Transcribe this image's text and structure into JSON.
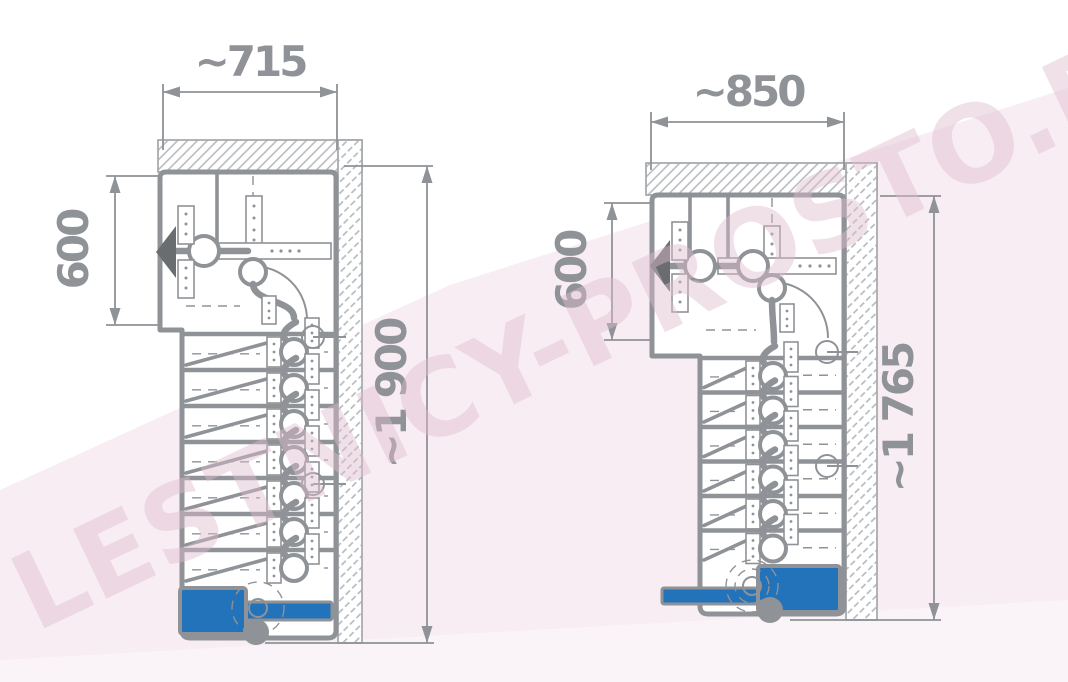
{
  "watermark_text": "LESTNICY-PROSTO.RU",
  "colors": {
    "accent_blue": "#2273b9",
    "line_gray": "#8f9296",
    "thin_gray": "#a6a9ac",
    "hatch_gray": "#b4b7ba",
    "background_pink": "#f7edf3",
    "background_pink_light": "#faf4f8",
    "watermark_pink": "rgba(222,189,207,0.45)"
  },
  "drawings": {
    "left": {
      "name": "compact modular staircase plan, width 715",
      "width_label": "~715",
      "depth_label": "600",
      "height_label": "~1 900",
      "flight_steps": 7
    },
    "right": {
      "name": "compact modular staircase plan, width 850",
      "width_label": "~850",
      "depth_label": "600",
      "height_label": "~1 765",
      "flight_steps": 6
    }
  }
}
